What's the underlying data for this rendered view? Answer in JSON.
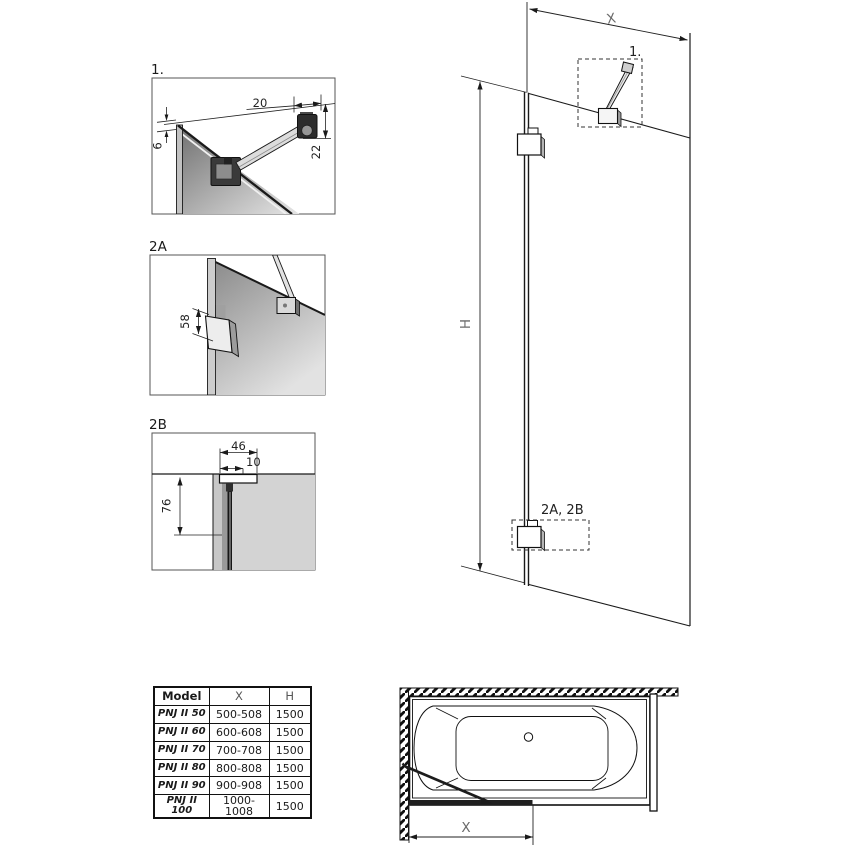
{
  "details": {
    "d1": {
      "label": "1.",
      "dim_arm": "20",
      "dim_gap": "6",
      "dim_drop": "22"
    },
    "d2a": {
      "label": "2A",
      "dim_bracket": "58"
    },
    "d2b": {
      "label": "2B",
      "dim_profile": "46",
      "dim_inner": "10",
      "dim_length": "76"
    }
  },
  "elevation": {
    "width_label": "X",
    "height_label": "H",
    "callout_detail1": "1.",
    "callout_details2": "2A, 2B"
  },
  "plan": {
    "width_label": "X"
  },
  "table": {
    "headers": {
      "model": "Model",
      "x": "X",
      "h": "H"
    },
    "rows": [
      {
        "model": "PNJ II 50",
        "x": "500-508",
        "h": "1500"
      },
      {
        "model": "PNJ II 60",
        "x": "600-608",
        "h": "1500"
      },
      {
        "model": "PNJ II 70",
        "x": "700-708",
        "h": "1500"
      },
      {
        "model": "PNJ II 80",
        "x": "800-808",
        "h": "1500"
      },
      {
        "model": "PNJ II 90",
        "x": "900-908",
        "h": "1500"
      },
      {
        "model": "PNJ II 100",
        "x": "1000-1008",
        "h": "1500"
      }
    ]
  },
  "colors": {
    "line": "#1a1a1a",
    "dim_text": "#222222",
    "axis_text": "#6a6a6a",
    "glass_dark": "#6e6e6e",
    "glass_light": "#e6e6e6",
    "section_gray": "#d3d3d3"
  }
}
